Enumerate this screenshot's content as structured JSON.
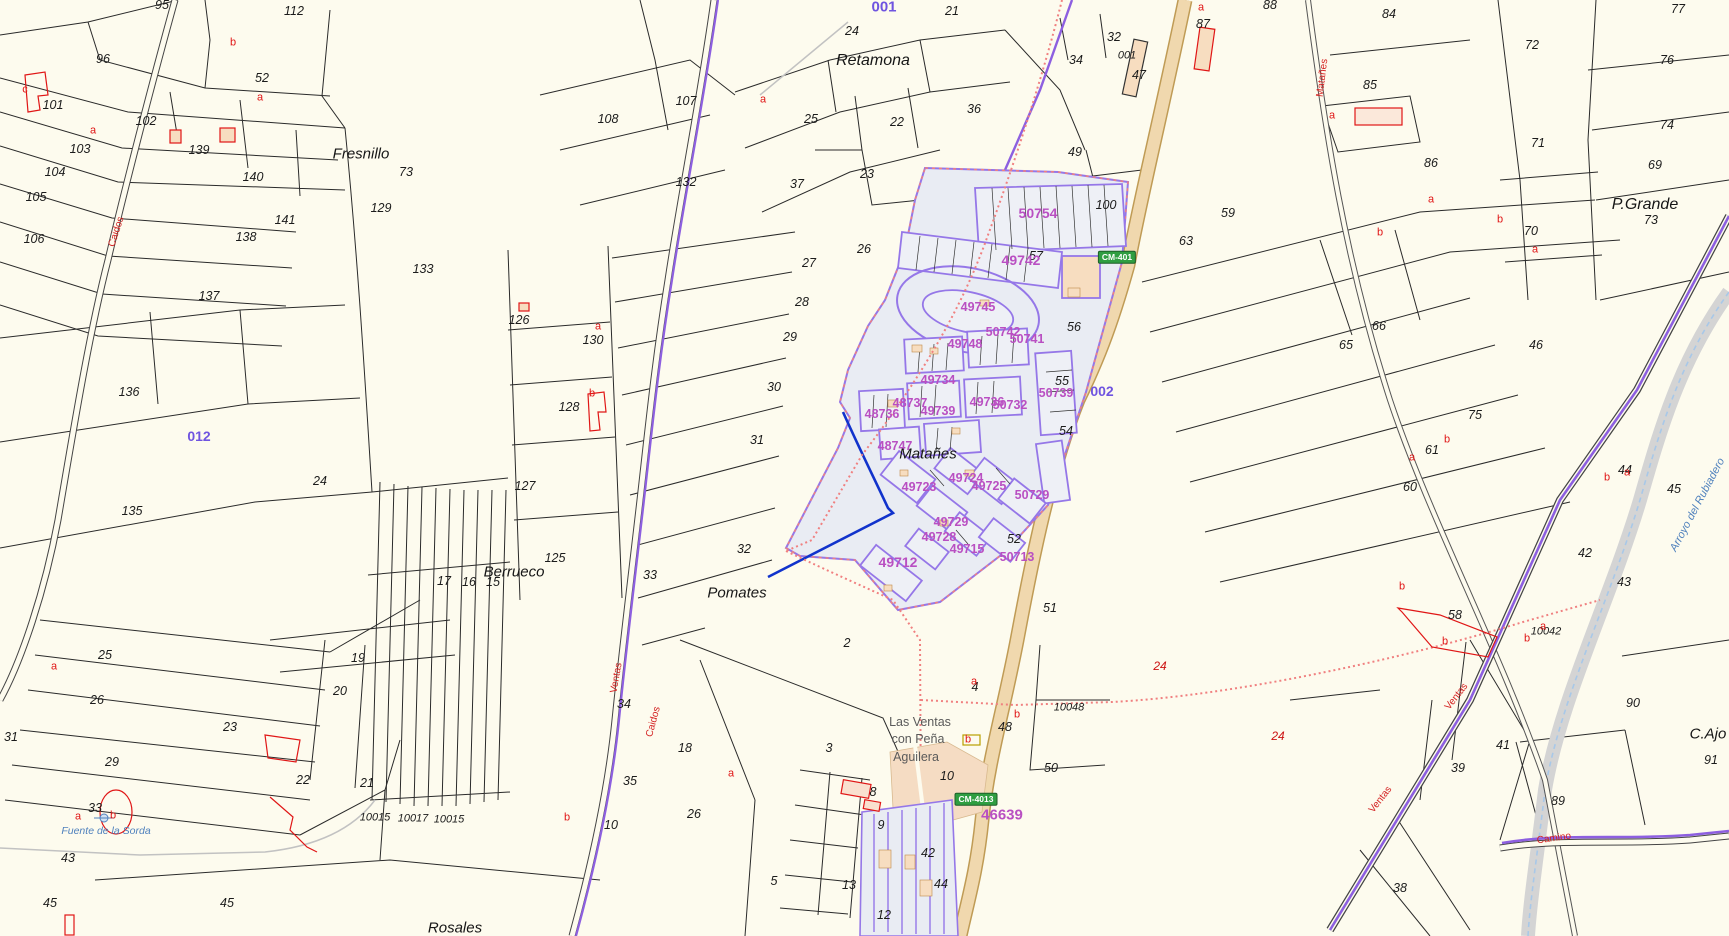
{
  "map": {
    "colors": {
      "background": "#fdfbee",
      "parcel_line": "#222222",
      "urban_fill": "#e9ecf3",
      "urban_outline": "#9577e8",
      "municipal_dotted": "#f08080",
      "highway_fill": "#f0d8ae",
      "highway_edge": "#bf9b55",
      "boundary_purple": "#8d5fe0",
      "urban_label": "#b94fc2",
      "polygon_label": "#6f54e0",
      "red_annotation": "#e01616",
      "water_blue": "#4f81bd",
      "sign_green": "#2f9e41"
    },
    "labels": [
      {
        "t": "95",
        "x": 162,
        "y": 5
      },
      {
        "t": "112",
        "x": 294,
        "y": 11
      },
      {
        "t": "96",
        "x": 103,
        "y": 59
      },
      {
        "t": "52",
        "x": 262,
        "y": 78
      },
      {
        "t": "101",
        "x": 53,
        "y": 105
      },
      {
        "t": "102",
        "x": 146,
        "y": 121
      },
      {
        "t": "103",
        "x": 80,
        "y": 149
      },
      {
        "t": "139",
        "x": 199,
        "y": 150
      },
      {
        "t": "140",
        "x": 253,
        "y": 177
      },
      {
        "t": "104",
        "x": 55,
        "y": 172
      },
      {
        "t": "105",
        "x": 36,
        "y": 197
      },
      {
        "t": "106",
        "x": 34,
        "y": 239
      },
      {
        "t": "138",
        "x": 246,
        "y": 237
      },
      {
        "t": "137",
        "x": 209,
        "y": 296
      },
      {
        "t": "136",
        "x": 129,
        "y": 392
      },
      {
        "t": "135",
        "x": 132,
        "y": 511
      },
      {
        "t": "24",
        "x": 320,
        "y": 481
      },
      {
        "t": "73",
        "x": 406,
        "y": 172
      },
      {
        "t": "129",
        "x": 381,
        "y": 208
      },
      {
        "t": "141",
        "x": 285,
        "y": 220
      },
      {
        "t": "133",
        "x": 423,
        "y": 269
      },
      {
        "t": "126",
        "x": 519,
        "y": 320
      },
      {
        "t": "130",
        "x": 593,
        "y": 340
      },
      {
        "t": "128",
        "x": 569,
        "y": 407
      },
      {
        "t": "127",
        "x": 525,
        "y": 486
      },
      {
        "t": "125",
        "x": 555,
        "y": 558
      },
      {
        "t": "107",
        "x": 686,
        "y": 101
      },
      {
        "t": "108",
        "x": 608,
        "y": 119
      },
      {
        "t": "132",
        "x": 686,
        "y": 182
      },
      {
        "t": "27",
        "x": 809,
        "y": 263
      },
      {
        "t": "28",
        "x": 802,
        "y": 302
      },
      {
        "t": "29",
        "x": 790,
        "y": 337
      },
      {
        "t": "30",
        "x": 774,
        "y": 387
      },
      {
        "t": "31",
        "x": 757,
        "y": 440
      },
      {
        "t": "32",
        "x": 744,
        "y": 549
      },
      {
        "t": "33",
        "x": 650,
        "y": 575
      },
      {
        "t": "17",
        "x": 444,
        "y": 581
      },
      {
        "t": "16",
        "x": 469,
        "y": 582
      },
      {
        "t": "15",
        "x": 493,
        "y": 582
      },
      {
        "t": "19",
        "x": 358,
        "y": 658
      },
      {
        "t": "20",
        "x": 340,
        "y": 691
      },
      {
        "t": "23",
        "x": 230,
        "y": 727
      },
      {
        "t": "25",
        "x": 105,
        "y": 655
      },
      {
        "t": "26",
        "x": 97,
        "y": 700
      },
      {
        "t": "31",
        "x": 11,
        "y": 737
      },
      {
        "t": "29",
        "x": 112,
        "y": 762
      },
      {
        "t": "33",
        "x": 95,
        "y": 808
      },
      {
        "t": "43",
        "x": 68,
        "y": 858
      },
      {
        "t": "45",
        "x": 50,
        "y": 903
      },
      {
        "t": "45",
        "x": 227,
        "y": 903
      },
      {
        "t": "22",
        "x": 303,
        "y": 780
      },
      {
        "t": "21",
        "x": 367,
        "y": 783
      },
      {
        "t": "10015",
        "x": 375,
        "y": 818,
        "s": 11
      },
      {
        "t": "10017",
        "x": 413,
        "y": 819,
        "s": 11
      },
      {
        "t": "10015",
        "x": 449,
        "y": 820,
        "s": 11
      },
      {
        "t": "34",
        "x": 624,
        "y": 704
      },
      {
        "t": "35",
        "x": 630,
        "y": 781
      },
      {
        "t": "18",
        "x": 685,
        "y": 748
      },
      {
        "t": "26",
        "x": 694,
        "y": 814
      },
      {
        "t": "10",
        "x": 611,
        "y": 825
      },
      {
        "t": "3",
        "x": 829,
        "y": 748
      },
      {
        "t": "2",
        "x": 847,
        "y": 643
      },
      {
        "t": "4",
        "x": 975,
        "y": 687
      },
      {
        "t": "10",
        "x": 947,
        "y": 776
      },
      {
        "t": "50",
        "x": 1051,
        "y": 768
      },
      {
        "t": "48",
        "x": 1005,
        "y": 727
      },
      {
        "t": "10048",
        "x": 1069,
        "y": 708,
        "s": 11
      },
      {
        "t": "8",
        "x": 873,
        "y": 792
      },
      {
        "t": "9",
        "x": 881,
        "y": 825
      },
      {
        "t": "13",
        "x": 849,
        "y": 885
      },
      {
        "t": "5",
        "x": 774,
        "y": 881
      },
      {
        "t": "12",
        "x": 884,
        "y": 915
      },
      {
        "t": "42",
        "x": 928,
        "y": 853
      },
      {
        "t": "44",
        "x": 941,
        "y": 884
      },
      {
        "t": "24",
        "x": 852,
        "y": 31
      },
      {
        "t": "21",
        "x": 952,
        "y": 11
      },
      {
        "t": "25",
        "x": 811,
        "y": 119
      },
      {
        "t": "22",
        "x": 897,
        "y": 122
      },
      {
        "t": "23",
        "x": 867,
        "y": 174
      },
      {
        "t": "36",
        "x": 974,
        "y": 109
      },
      {
        "t": "37",
        "x": 797,
        "y": 184
      },
      {
        "t": "26",
        "x": 864,
        "y": 249
      },
      {
        "t": "32",
        "x": 1114,
        "y": 37
      },
      {
        "t": "34",
        "x": 1076,
        "y": 60
      },
      {
        "t": "001",
        "x": 1127,
        "y": 56,
        "s": 11
      },
      {
        "t": "47",
        "x": 1139,
        "y": 75
      },
      {
        "t": "87",
        "x": 1203,
        "y": 24
      },
      {
        "t": "49",
        "x": 1075,
        "y": 152
      },
      {
        "t": "100",
        "x": 1106,
        "y": 205
      },
      {
        "t": "59",
        "x": 1228,
        "y": 213
      },
      {
        "t": "57",
        "x": 1036,
        "y": 256
      },
      {
        "t": "56",
        "x": 1074,
        "y": 327
      },
      {
        "t": "55",
        "x": 1062,
        "y": 381
      },
      {
        "t": "54",
        "x": 1066,
        "y": 431
      },
      {
        "t": "52",
        "x": 1014,
        "y": 539
      },
      {
        "t": "51",
        "x": 1050,
        "y": 608
      },
      {
        "t": "88",
        "x": 1270,
        "y": 5
      },
      {
        "t": "84",
        "x": 1389,
        "y": 14
      },
      {
        "t": "85",
        "x": 1370,
        "y": 85
      },
      {
        "t": "86",
        "x": 1431,
        "y": 163
      },
      {
        "t": "72",
        "x": 1532,
        "y": 45
      },
      {
        "t": "77",
        "x": 1678,
        "y": 9
      },
      {
        "t": "76",
        "x": 1667,
        "y": 60
      },
      {
        "t": "74",
        "x": 1667,
        "y": 125
      },
      {
        "t": "71",
        "x": 1538,
        "y": 143
      },
      {
        "t": "70",
        "x": 1531,
        "y": 231
      },
      {
        "t": "73",
        "x": 1651,
        "y": 220
      },
      {
        "t": "63",
        "x": 1186,
        "y": 241
      },
      {
        "t": "65",
        "x": 1346,
        "y": 345
      },
      {
        "t": "66",
        "x": 1379,
        "y": 326
      },
      {
        "t": "46",
        "x": 1536,
        "y": 345
      },
      {
        "t": "69",
        "x": 1655,
        "y": 165
      },
      {
        "t": "75",
        "x": 1475,
        "y": 415
      },
      {
        "t": "61",
        "x": 1432,
        "y": 450
      },
      {
        "t": "60",
        "x": 1410,
        "y": 487
      },
      {
        "t": "44",
        "x": 1625,
        "y": 470
      },
      {
        "t": "45",
        "x": 1674,
        "y": 489
      },
      {
        "t": "42",
        "x": 1585,
        "y": 553
      },
      {
        "t": "43",
        "x": 1624,
        "y": 582
      },
      {
        "t": "58",
        "x": 1455,
        "y": 615
      },
      {
        "t": "10042",
        "x": 1546,
        "y": 632,
        "s": 11
      },
      {
        "t": "41",
        "x": 1503,
        "y": 745
      },
      {
        "t": "39",
        "x": 1458,
        "y": 768
      },
      {
        "t": "89",
        "x": 1558,
        "y": 801
      },
      {
        "t": "90",
        "x": 1633,
        "y": 703
      },
      {
        "t": "91",
        "x": 1711,
        "y": 760
      },
      {
        "t": "38",
        "x": 1400,
        "y": 888
      },
      {
        "t": "50754",
        "x": 1038,
        "y": 213,
        "c": "mag",
        "s": 14
      },
      {
        "t": "49742",
        "x": 1021,
        "y": 260,
        "c": "mag",
        "s": 14
      },
      {
        "t": "49745",
        "x": 978,
        "y": 307,
        "c": "mag"
      },
      {
        "t": "50742",
        "x": 1003,
        "y": 332,
        "c": "mag"
      },
      {
        "t": "50741",
        "x": 1027,
        "y": 339,
        "c": "mag"
      },
      {
        "t": "49748",
        "x": 965,
        "y": 344,
        "c": "mag"
      },
      {
        "t": "49734",
        "x": 938,
        "y": 380,
        "c": "mag"
      },
      {
        "t": "50739",
        "x": 1056,
        "y": 393,
        "c": "mag"
      },
      {
        "t": "49736",
        "x": 987,
        "y": 402,
        "c": "mag"
      },
      {
        "t": "50732",
        "x": 1010,
        "y": 405,
        "c": "mag"
      },
      {
        "t": "48737",
        "x": 910,
        "y": 403,
        "c": "mag"
      },
      {
        "t": "49739",
        "x": 938,
        "y": 411,
        "c": "mag"
      },
      {
        "t": "48736",
        "x": 882,
        "y": 414,
        "c": "mag"
      },
      {
        "t": "48747",
        "x": 895,
        "y": 446,
        "c": "mag"
      },
      {
        "t": "49723",
        "x": 919,
        "y": 487,
        "c": "mag"
      },
      {
        "t": "49724",
        "x": 966,
        "y": 478,
        "c": "mag"
      },
      {
        "t": "49725",
        "x": 989,
        "y": 486,
        "c": "mag"
      },
      {
        "t": "50729",
        "x": 1032,
        "y": 495,
        "c": "mag"
      },
      {
        "t": "49729",
        "x": 951,
        "y": 522,
        "c": "mag"
      },
      {
        "t": "49728",
        "x": 939,
        "y": 537,
        "c": "mag"
      },
      {
        "t": "49715",
        "x": 967,
        "y": 549,
        "c": "mag"
      },
      {
        "t": "50713",
        "x": 1017,
        "y": 557,
        "c": "mag"
      },
      {
        "t": "49712",
        "x": 898,
        "y": 562,
        "c": "mag",
        "s": 14
      },
      {
        "t": "46639",
        "x": 1002,
        "y": 815,
        "c": "mag",
        "s": 15
      },
      {
        "t": "001",
        "x": 884,
        "y": 7,
        "c": "pid",
        "s": 15
      },
      {
        "t": "012",
        "x": 199,
        "y": 436,
        "c": "pid"
      },
      {
        "t": "002",
        "x": 1102,
        "y": 391,
        "c": "pid"
      },
      {
        "t": "Fresnillo",
        "x": 361,
        "y": 154,
        "c": "place"
      },
      {
        "t": "Retamona",
        "x": 873,
        "y": 61,
        "c": "place",
        "s": 16
      },
      {
        "t": "P.Grande",
        "x": 1645,
        "y": 205,
        "c": "place",
        "s": 16
      },
      {
        "t": "Berrueco",
        "x": 514,
        "y": 572,
        "c": "place"
      },
      {
        "t": "Pomates",
        "x": 737,
        "y": 593,
        "c": "place"
      },
      {
        "t": "Matañes",
        "x": 928,
        "y": 454,
        "c": "place"
      },
      {
        "t": "Rosales",
        "x": 455,
        "y": 928,
        "c": "place"
      },
      {
        "t": "C.Ajo",
        "x": 1708,
        "y": 734,
        "c": "place"
      },
      {
        "t": "Las Ventas",
        "x": 920,
        "y": 722,
        "c": "gplace"
      },
      {
        "t": "con Peña",
        "x": 918,
        "y": 739,
        "c": "gplace"
      },
      {
        "t": "Aguilera",
        "x": 916,
        "y": 757,
        "c": "gplace"
      },
      {
        "t": "Fuente de la Sorda",
        "x": 106,
        "y": 831,
        "c": "blue"
      },
      {
        "t": "Arroyo del Rubiadero",
        "x": 1698,
        "y": 505,
        "c": "blue",
        "r": -62,
        "s": 11
      },
      {
        "t": "Matañes",
        "x": 1323,
        "y": 78,
        "c": "road",
        "r": -83
      },
      {
        "t": "Caidos",
        "x": 117,
        "y": 232,
        "c": "road",
        "r": -72
      },
      {
        "t": "Ventas",
        "x": 617,
        "y": 678,
        "c": "road",
        "r": -80
      },
      {
        "t": "Caidos",
        "x": 654,
        "y": 722,
        "c": "road",
        "r": -75
      },
      {
        "t": "Ventas",
        "x": 1457,
        "y": 697,
        "c": "road",
        "r": -52
      },
      {
        "t": "Ventas",
        "x": 1381,
        "y": 800,
        "c": "road",
        "r": -52
      },
      {
        "t": "Camino",
        "x": 1554,
        "y": 839,
        "c": "road",
        "r": -8
      },
      {
        "t": "CM-401",
        "x": 1117,
        "y": 257,
        "c": "sign",
        "n": "road-sign-cm401"
      },
      {
        "t": "CM-4013",
        "x": 976,
        "y": 799,
        "c": "sign",
        "n": "road-sign-cm4013"
      },
      {
        "t": "a",
        "x": 93,
        "y": 131,
        "c": "red"
      },
      {
        "t": "a",
        "x": 260,
        "y": 98,
        "c": "red"
      },
      {
        "t": "b",
        "x": 233,
        "y": 43,
        "c": "red"
      },
      {
        "t": "c",
        "x": 25,
        "y": 90,
        "c": "red"
      },
      {
        "t": "a",
        "x": 763,
        "y": 100,
        "c": "red"
      },
      {
        "t": "a",
        "x": 1201,
        "y": 8,
        "c": "red"
      },
      {
        "t": "a",
        "x": 1332,
        "y": 116,
        "c": "red"
      },
      {
        "t": "a",
        "x": 1431,
        "y": 200,
        "c": "red"
      },
      {
        "t": "a",
        "x": 1535,
        "y": 250,
        "c": "red"
      },
      {
        "t": "b",
        "x": 1500,
        "y": 220,
        "c": "red"
      },
      {
        "t": "b",
        "x": 1380,
        "y": 233,
        "c": "red"
      },
      {
        "t": "a",
        "x": 1412,
        "y": 458,
        "c": "red"
      },
      {
        "t": "b",
        "x": 1447,
        "y": 440,
        "c": "red"
      },
      {
        "t": "a",
        "x": 1627,
        "y": 473,
        "c": "red"
      },
      {
        "t": "b",
        "x": 1607,
        "y": 478,
        "c": "red"
      },
      {
        "t": "b",
        "x": 1402,
        "y": 587,
        "c": "red"
      },
      {
        "t": "b",
        "x": 1445,
        "y": 642,
        "c": "red"
      },
      {
        "t": "a",
        "x": 1543,
        "y": 627,
        "c": "red"
      },
      {
        "t": "b",
        "x": 1527,
        "y": 639,
        "c": "red"
      },
      {
        "t": "a",
        "x": 974,
        "y": 682,
        "c": "red"
      },
      {
        "t": "b",
        "x": 1017,
        "y": 715,
        "c": "red"
      },
      {
        "t": "b",
        "x": 968,
        "y": 740,
        "c": "red"
      },
      {
        "t": "a",
        "x": 78,
        "y": 817,
        "c": "red"
      },
      {
        "t": "b",
        "x": 113,
        "y": 816,
        "c": "red"
      },
      {
        "t": "a",
        "x": 54,
        "y": 667,
        "c": "red"
      },
      {
        "t": "b",
        "x": 567,
        "y": 818,
        "c": "red"
      },
      {
        "t": "a",
        "x": 731,
        "y": 774,
        "c": "red"
      },
      {
        "t": "a",
        "x": 598,
        "y": 327,
        "c": "red"
      },
      {
        "t": "b",
        "x": 592,
        "y": 394,
        "c": "red"
      },
      {
        "t": "24",
        "x": 1160,
        "y": 666,
        "c": "rednum"
      },
      {
        "t": "24",
        "x": 1278,
        "y": 736,
        "c": "rednum"
      }
    ]
  }
}
